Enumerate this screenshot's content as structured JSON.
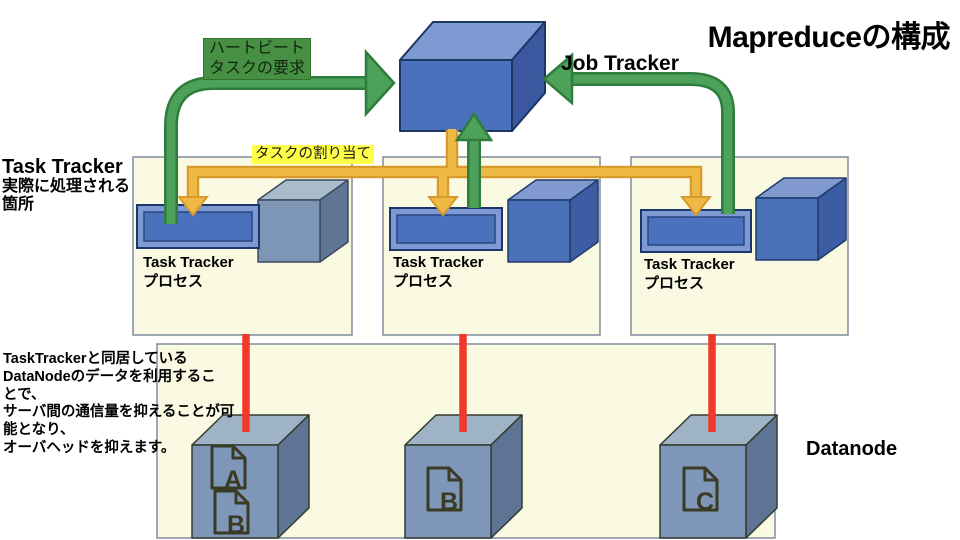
{
  "title": "Mapreduceの構成",
  "job_tracker": {
    "label": "Job Tracker"
  },
  "arrows": {
    "heartbeat_label_line1": "ハートビート",
    "heartbeat_label_line2": "タスクの要求",
    "assignment_label": "タスクの割り当て"
  },
  "left_heading": {
    "line1": "Task Tracker",
    "line2": "実際に処理される",
    "line3": "箇所"
  },
  "note": {
    "lines": [
      "TaskTrackerと同居している",
      "DataNodeのデータを利用するこ",
      "とで、",
      "サーバ間の通信量を抑えることが可",
      "能となり、",
      "オーバヘッドを抑えます。"
    ]
  },
  "tracker_nodes": [
    {
      "label_line1": "Task Tracker",
      "label_line2": "プロセス"
    },
    {
      "label_line1": "Task Tracker",
      "label_line2": "プロセス"
    },
    {
      "label_line1": "Task Tracker",
      "label_line2": "プロセス"
    }
  ],
  "datanodes": {
    "label": "Datanode",
    "cubes": [
      {
        "documents": [
          "A",
          "B"
        ]
      },
      {
        "documents": [
          "B"
        ]
      },
      {
        "documents": [
          "C"
        ]
      }
    ]
  },
  "colors": {
    "cube_blue_front": "#4a72bc",
    "cube_blue_top": "#7e9ad2",
    "cube_blue_side": "#3a57a0",
    "cube_gray_front": "#7e96b5",
    "cube_gray_top": "#a9bccc",
    "cube_gray_side": "#5f7594",
    "node_box_fill": "#fafae3",
    "node_box_border": "#7e8ca2",
    "arrow_green": "#4da15b",
    "arrow_green_border": "#2e7d3c",
    "arrow_yellow": "#efb945",
    "arrow_yellow_border": "#d89a2b",
    "line_red": "#ee392b",
    "heartbeat_label_bg": "#478f43",
    "assignment_label_bg": "#ffff47",
    "doc_icon_color": "#3a3b24"
  }
}
